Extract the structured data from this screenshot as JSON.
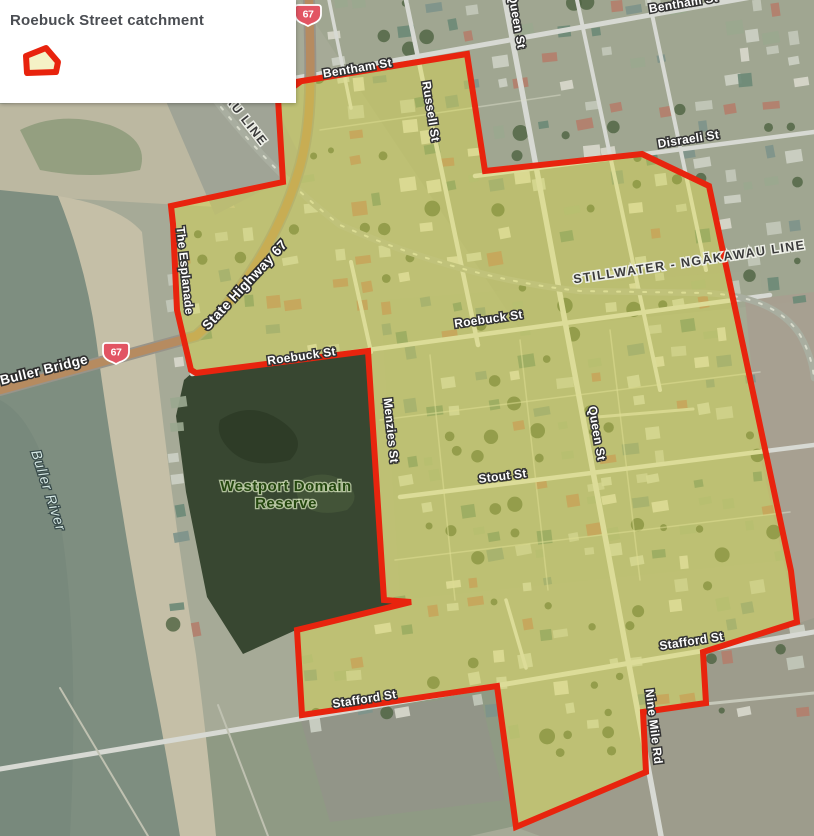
{
  "legend": {
    "title": "Roebuck Street catchment",
    "swatch": {
      "name": "catchment-polygon-swatch",
      "stroke": "#e8230d",
      "fill": "#f5f2c6",
      "points": "6,14 26,6 38,20 36,30 7,31"
    }
  },
  "map": {
    "colors": {
      "boundary_red": "#e8240e",
      "catchment_tint": "rgba(228,226,66,0.40)",
      "water": "#7e8e80",
      "sand": "#c5bfa7",
      "forest": "#384731",
      "road": "#d7d9d3",
      "highway": "#b68b60",
      "shield_red": "#e25563"
    },
    "catchment": {
      "name": "Roebuck Street catchment boundary",
      "fill": "rgba(228,226,66,0.40)",
      "stroke": "#e8240e",
      "stroke_width": 6,
      "points": "296,82 467,54 485,171 642,154 709,186 791,571 797,622 703,652 706,703 643,712 646,772 516,827 497,686 302,715 297,630 411,602 384,600 368,351 196,373 191,370 177,310 173,224 171,206 283,182 278,98 300,82"
    },
    "shapes_under": [
      {
        "name": "block-tint-north",
        "d": "M300,0 L814,0 L814,300 L520,330 Z",
        "fill": "#9aa28a",
        "op": 0.45
      },
      {
        "name": "block-tint-mid",
        "d": "M380,300 L760,270 L790,560 L400,600 Z",
        "fill": "#a3ab90",
        "op": 0.4
      },
      {
        "name": "rural-east",
        "d": "M745,300 L814,292 L814,625 L797,622 L760,455 Z",
        "fill": "#a79f90",
        "op": 0.9
      },
      {
        "name": "rural-southeast",
        "d": "M703,655 L814,618 L814,836 L540,836 L518,828 L645,773 L643,713 L706,704 Z",
        "fill": "#9d9c8c",
        "op": 1
      },
      {
        "name": "fields-south",
        "d": "M0,770 L252,727 L497,688 L515,826 L470,836 L0,836 Z",
        "fill": "#8f9a84",
        "op": 1
      },
      {
        "name": "field-patch",
        "d": "M300,718 L480,695 L505,800 L330,822 Z",
        "fill": "#94938a",
        "op": 0.6
      },
      {
        "name": "river-bank",
        "d": "M118,300 Q140,450 165,580 Q185,680 205,745 L165,770 Q140,650 125,540 Q110,420 104,330 Z",
        "fill": "#74856a",
        "op": 1
      },
      {
        "name": "sand-northwest",
        "d": "M0,104 L190,92 L235,208 L60,198 L0,192 Z",
        "fill": "#bcb8a1",
        "op": 1
      },
      {
        "name": "scrub-northwest",
        "d": "M20,130 Q60,110 110,125 Q150,140 140,170 Q90,180 40,170 Z",
        "fill": "#8a9878",
        "op": 0.8
      },
      {
        "name": "river-water",
        "d": "M0,190 L58,196 Q88,268 98,340 Q110,430 124,512 Q140,612 160,712 Q172,778 180,836 L0,836 Z",
        "fill": "#7e8e80",
        "op": 1
      },
      {
        "name": "water-shade",
        "d": "M0,400 Q40,420 60,520 Q80,640 70,836 L0,836 Z",
        "fill": "#76877b",
        "op": 0.7
      },
      {
        "name": "sand-shore",
        "d": "M58,196 Q120,206 142,232 Q152,330 164,430 Q178,545 196,655 Q208,748 216,836 L180,836 Q170,775 158,710 Q138,610 122,510 Q108,428 96,338 Q86,266 58,196 Z",
        "fill": "#c5bfa7",
        "op": 1
      },
      {
        "name": "rail-yard",
        "d": "M162,92 L250,56 L306,168 L215,215 Z",
        "fill": "#a0a496",
        "op": 1
      },
      {
        "name": "domain-forest",
        "d": "M193,372 L368,350 L385,602 L411,604 L296,630 L243,654 L207,597 L186,492 L176,416 L184,380 Z",
        "fill": "#384731",
        "op": 1
      },
      {
        "name": "forest-shadow",
        "d": "M220,420 q30,-20 60,0 q30,20 10,40 q-40,10 -60,-10 q-15,-15 -10,-30 Z",
        "fill": "#2c3a26",
        "op": 0.8
      },
      {
        "name": "forest-light",
        "d": "M300,480 q25,-12 45,2 q18,14 2,28 q-30,8 -45,-6 q-10,-12 -2,-24 Z",
        "fill": "#46573b",
        "op": 0.8
      }
    ],
    "roads": [
      {
        "name": "road-bentham",
        "d": "M296,78 L780,-8",
        "w": 5,
        "c": "#d7d9d3"
      },
      {
        "name": "road-disraeli",
        "d": "M475,176 L814,132",
        "w": 4.5,
        "c": "#d7d9d3"
      },
      {
        "name": "road-roebuck",
        "d": "M192,374 L770,295",
        "w": 4.5,
        "c": "#d7d9d3"
      },
      {
        "name": "road-stout",
        "d": "M400,497 L814,445",
        "w": 4.5,
        "c": "#d7d9d3"
      },
      {
        "name": "road-stafford",
        "d": "M0,769 L252,727 L814,632",
        "w": 5,
        "c": "#d7d9d3"
      },
      {
        "name": "road-russell",
        "d": "M406,0 L478,345",
        "w": 4.5,
        "c": "#d7d9d3"
      },
      {
        "name": "road-queen-ninemile",
        "d": "M505,0 L661,836",
        "w": 5.5,
        "c": "#d7d9d3"
      },
      {
        "name": "road-east-a",
        "d": "M577,0 L660,390",
        "w": 4,
        "c": "#d7d9d3"
      },
      {
        "name": "road-east-b",
        "d": "M649,0 L706,270",
        "w": 4,
        "c": "#d7d9d3"
      },
      {
        "name": "road-top-west",
        "d": "M329,0 L351,108",
        "w": 3.5,
        "c": "#d7d9d3"
      },
      {
        "name": "road-menzies-north",
        "d": "M351,262 L371,352",
        "w": 4,
        "c": "#d7d9d3"
      },
      {
        "name": "road-south-connector",
        "d": "M506,600 L526,668",
        "w": 3.5,
        "c": "#d7d9d3"
      },
      {
        "name": "lane-east",
        "d": "M597,417 L693,409",
        "w": 3,
        "c": "#cfd1c3"
      },
      {
        "name": "track-southeast",
        "d": "M705,704 L814,693",
        "w": 3,
        "c": "#c6c8ba"
      },
      {
        "name": "fence-field-1",
        "d": "M60,688 L148,836",
        "w": 2,
        "c": "#bfc1b1"
      },
      {
        "name": "fence-field-2",
        "d": "M218,705 L268,836",
        "w": 2,
        "c": "#bfc1b1"
      },
      {
        "name": "fence-a",
        "d": "M380,420 L760,372",
        "w": 1.5,
        "c": "#d9dbc9",
        "op": 0.55
      },
      {
        "name": "fence-b",
        "d": "M395,560 L790,512",
        "w": 1.5,
        "c": "#d9dbc9",
        "op": 0.55
      },
      {
        "name": "fence-c",
        "d": "M430,355 L455,600",
        "w": 1.5,
        "c": "#d9dbc9",
        "op": 0.55
      },
      {
        "name": "fence-d",
        "d": "M520,340 L548,590",
        "w": 1.5,
        "c": "#d9dbc9",
        "op": 0.55
      },
      {
        "name": "fence-e",
        "d": "M610,330 L640,580",
        "w": 1.5,
        "c": "#d9dbc9",
        "op": 0.55
      },
      {
        "name": "fence-f",
        "d": "M320,130 L560,95",
        "w": 1.5,
        "c": "#d9dbc9",
        "op": 0.5
      },
      {
        "name": "railway-corridor",
        "d": "M182,55 Q255,160 340,225 Q460,278 580,291 L705,293 Q775,296 800,335 Q812,356 814,378",
        "w": 6.5,
        "c": "#a9aea0"
      },
      {
        "name": "railway-ties",
        "d": "M182,55 Q255,160 340,225 Q460,278 580,291 L705,293 Q775,296 800,335 Q812,356 814,378",
        "w": 2,
        "c": "#d8dbcc",
        "dash": "3,10"
      },
      {
        "name": "highway67-casing",
        "d": "M309,0 C311,75 313,128 297,176 C279,235 240,298 196,336 L0,390",
        "w": 12,
        "c": "#98948a"
      },
      {
        "name": "highway67",
        "d": "M309,0 C311,75 313,128 297,176 C279,235 240,298 196,336 L0,390",
        "w": 8.5,
        "c": "#b68b60"
      }
    ],
    "labels": [
      {
        "text": "Bentham St",
        "x": 358,
        "y": 72,
        "rot": -9.5,
        "style": "road"
      },
      {
        "text": "Bentham St",
        "x": 684,
        "y": 7,
        "rot": -9.5,
        "style": "road"
      },
      {
        "text": "Russell St",
        "x": 427,
        "y": 112,
        "rot": 81,
        "style": "road"
      },
      {
        "text": "Queen St",
        "x": 513,
        "y": 22,
        "rot": 80,
        "style": "road"
      },
      {
        "text": "Disraeli St",
        "x": 689,
        "y": 143,
        "rot": -9,
        "style": "road"
      },
      {
        "text": "STILLWATER - NGĀKAWAU LINE",
        "x": 690,
        "y": 266,
        "rot": -8.5,
        "style": "rail"
      },
      {
        "text": "AU LINE",
        "x": 243,
        "y": 123,
        "rot": 52,
        "style": "rail"
      },
      {
        "text": "The Esplanade",
        "x": 181,
        "y": 271,
        "rot": 84,
        "style": "road"
      },
      {
        "text": "State Highway 67",
        "x": 248,
        "y": 288,
        "rot": -47,
        "style": "road-lg"
      },
      {
        "text": "Buller Bridge",
        "x": 45,
        "y": 374,
        "rot": -14,
        "style": "road-lg"
      },
      {
        "text": "Roebuck St",
        "x": 302,
        "y": 360,
        "rot": -8,
        "style": "road"
      },
      {
        "text": "Roebuck St",
        "x": 489,
        "y": 323,
        "rot": -8,
        "style": "road"
      },
      {
        "text": "Menzies St",
        "x": 387,
        "y": 431,
        "rot": 84,
        "style": "road"
      },
      {
        "text": "Stout St",
        "x": 503,
        "y": 480,
        "rot": -7,
        "style": "road"
      },
      {
        "text": "Queen St",
        "x": 593,
        "y": 434,
        "rot": 80,
        "style": "road"
      },
      {
        "text": "Stafford St",
        "x": 365,
        "y": 703,
        "rot": -9,
        "style": "road"
      },
      {
        "text": "Stafford St",
        "x": 692,
        "y": 645,
        "rot": -9,
        "style": "road"
      },
      {
        "text": "Nine Mile Rd",
        "x": 650,
        "y": 727,
        "rot": 83,
        "style": "road"
      },
      {
        "text": "Buller River",
        "x": 44,
        "y": 492,
        "rot": 72,
        "style": "water"
      }
    ],
    "reserve_label": {
      "lines": [
        "Westport Domain",
        "Reserve"
      ],
      "x": 286,
      "y": 491,
      "line_height": 17,
      "style": "reserve"
    },
    "shields": [
      {
        "text": "67",
        "x": 308,
        "y": 14
      },
      {
        "text": "67",
        "x": 116,
        "y": 352
      }
    ]
  }
}
